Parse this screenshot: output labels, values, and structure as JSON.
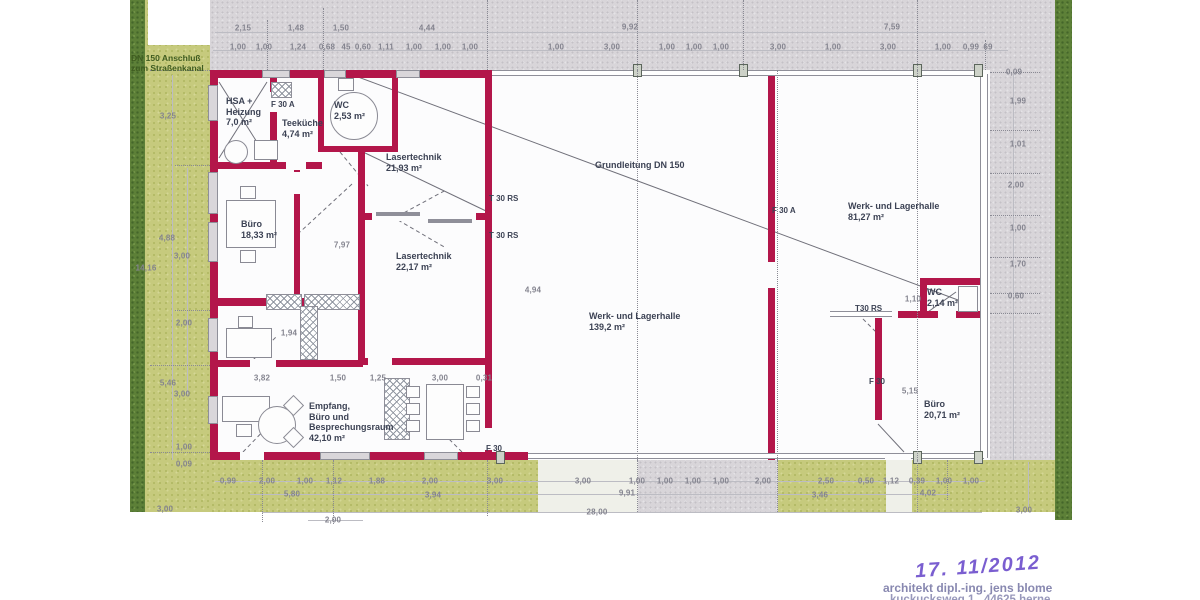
{
  "title": "Grundriss Werk- und Lagerhalle",
  "colors": {
    "wall": "#b3164a",
    "gray_wall": "#8f8f99",
    "pavement": "#d8d5d9",
    "green": "#c6ca7d",
    "green_dark": "#5d8038",
    "dim_text": "#84848f",
    "room_text": "#3c4254",
    "stamp_purple": "#7a5ed0",
    "stamp_gray": "#8888b0"
  },
  "stamp": {
    "date": "17. 11/2012",
    "line1": "architekt dipl.-ing. jens blome",
    "line2": "kuckucksweg 1 . 44625 herne"
  },
  "labels": [
    {
      "t": "DN 150 Anschluß\nzum Straßenkanal",
      "x": 131,
      "y": 53,
      "c": "site"
    },
    {
      "t": "HSA +\nHeizung\n7,0 m²",
      "x": 226,
      "y": 96,
      "c": "room"
    },
    {
      "t": "F 30 A",
      "x": 271,
      "y": 100,
      "c": "door"
    },
    {
      "t": "Teeküche\n4,74 m²",
      "x": 282,
      "y": 118,
      "c": "room"
    },
    {
      "t": "WC\n2,53 m²",
      "x": 334,
      "y": 100,
      "c": "room"
    },
    {
      "t": "Lasertechnik\n21,93 m²",
      "x": 386,
      "y": 152,
      "c": "room"
    },
    {
      "t": "T 30 RS",
      "x": 489,
      "y": 194,
      "c": "door"
    },
    {
      "t": "T 30 RS",
      "x": 489,
      "y": 231,
      "c": "door"
    },
    {
      "t": "Lasertechnik\n22,17 m²",
      "x": 396,
      "y": 251,
      "c": "room"
    },
    {
      "t": "Büro\n18,33 m²",
      "x": 241,
      "y": 219,
      "c": "room"
    },
    {
      "t": "Grundleitung DN 150",
      "x": 595,
      "y": 160,
      "c": "room"
    },
    {
      "t": "F 30 A",
      "x": 772,
      "y": 206,
      "c": "door"
    },
    {
      "t": "Werk- und Lagerhalle\n81,27 m²",
      "x": 848,
      "y": 201,
      "c": "room"
    },
    {
      "t": "Werk- und Lagerhalle\n139,2 m²",
      "x": 589,
      "y": 311,
      "c": "room"
    },
    {
      "t": "WC\n2,14 m²",
      "x": 927,
      "y": 287,
      "c": "room"
    },
    {
      "t": "T30 RS",
      "x": 855,
      "y": 304,
      "c": "door"
    },
    {
      "t": "F 30",
      "x": 869,
      "y": 377,
      "c": "door"
    },
    {
      "t": "Büro\n20,71 m²",
      "x": 924,
      "y": 399,
      "c": "room"
    },
    {
      "t": "Empfang,\nBüro und\nBesprechungsraum\n42,10 m²",
      "x": 309,
      "y": 401,
      "c": "room"
    },
    {
      "t": "F 30",
      "x": 486,
      "y": 444,
      "c": "door"
    }
  ],
  "dims": [
    [
      "2,15",
      243,
      28
    ],
    [
      "1,48",
      296,
      28
    ],
    [
      "1,50",
      341,
      28
    ],
    [
      "4,44",
      427,
      28
    ],
    [
      "9,92",
      630,
      27
    ],
    [
      "7,59",
      892,
      27
    ],
    [
      "1,00",
      238,
      47
    ],
    [
      "1,00",
      264,
      47
    ],
    [
      "1,24",
      298,
      47
    ],
    [
      "0,68",
      327,
      47
    ],
    [
      "45",
      346,
      47
    ],
    [
      "0,60",
      363,
      47
    ],
    [
      "1,11",
      386,
      47
    ],
    [
      "1,00",
      414,
      47
    ],
    [
      "1,00",
      443,
      47
    ],
    [
      "1,00",
      470,
      47
    ],
    [
      "1,00",
      556,
      47
    ],
    [
      "3,00",
      612,
      47
    ],
    [
      "1,00",
      667,
      47
    ],
    [
      "1,00",
      694,
      47
    ],
    [
      "1,00",
      721,
      47
    ],
    [
      "3,00",
      778,
      47
    ],
    [
      "1,00",
      833,
      47
    ],
    [
      "3,00",
      888,
      47
    ],
    [
      "1,00",
      943,
      47
    ],
    [
      "0,99",
      971,
      47
    ],
    [
      "69",
      988,
      47
    ],
    [
      "0,09",
      1014,
      72
    ],
    [
      "3,25",
      168,
      116
    ],
    [
      "4,88",
      167,
      238
    ],
    [
      "3,00",
      182,
      256
    ],
    [
      "14,16",
      146,
      268
    ],
    [
      "2,00",
      184,
      323
    ],
    [
      "5,46",
      168,
      383
    ],
    [
      "3,00",
      182,
      394
    ],
    [
      "1,00",
      184,
      447
    ],
    [
      "0,09",
      184,
      464
    ],
    [
      "3,00",
      165,
      509
    ],
    [
      "1,99",
      1018,
      101
    ],
    [
      "1,01",
      1018,
      144
    ],
    [
      "2,00",
      1016,
      185
    ],
    [
      "1,00",
      1018,
      228
    ],
    [
      "1,70",
      1018,
      264
    ],
    [
      "0,60",
      1016,
      296
    ],
    [
      "3,00",
      1024,
      510
    ],
    [
      "7,97",
      342,
      245
    ],
    [
      "1,94",
      289,
      333
    ],
    [
      "4,94",
      533,
      290
    ],
    [
      "1,10",
      913,
      299
    ],
    [
      "5,15",
      910,
      391
    ],
    [
      "3,82",
      262,
      378
    ],
    [
      "1,50",
      338,
      378
    ],
    [
      "1,25",
      378,
      378
    ],
    [
      "3,00",
      440,
      378
    ],
    [
      "0,31",
      484,
      378
    ],
    [
      "0,99",
      228,
      481
    ],
    [
      "2,00",
      267,
      481
    ],
    [
      "1,00",
      305,
      481
    ],
    [
      "1,12",
      334,
      481
    ],
    [
      "1,88",
      377,
      481
    ],
    [
      "2,00",
      430,
      481
    ],
    [
      "3,00",
      495,
      481
    ],
    [
      "3,00",
      583,
      481
    ],
    [
      "1,00",
      637,
      481
    ],
    [
      "1,00",
      665,
      481
    ],
    [
      "1,00",
      693,
      481
    ],
    [
      "1,00",
      721,
      481
    ],
    [
      "2,00",
      763,
      481
    ],
    [
      "2,50",
      826,
      481
    ],
    [
      "0,50",
      866,
      481
    ],
    [
      "1,12",
      891,
      481
    ],
    [
      "0,39",
      917,
      481
    ],
    [
      "1,00",
      944,
      481
    ],
    [
      "1,00",
      971,
      481
    ],
    [
      "5,80",
      292,
      494
    ],
    [
      "3,94",
      433,
      495
    ],
    [
      "9,91",
      627,
      493
    ],
    [
      "3,46",
      820,
      495
    ],
    [
      "4,02",
      928,
      493
    ],
    [
      "2,00",
      333,
      520
    ],
    [
      "28,00",
      597,
      512
    ]
  ],
  "geometry": {
    "walls": [
      [
        210,
        70,
        54,
        8
      ],
      [
        290,
        70,
        34,
        8
      ],
      [
        346,
        70,
        50,
        8
      ],
      [
        420,
        70,
        72,
        8
      ],
      [
        210,
        70,
        8,
        390
      ],
      [
        210,
        452,
        32,
        8
      ],
      [
        264,
        452,
        58,
        8
      ],
      [
        370,
        452,
        54,
        8
      ],
      [
        458,
        452,
        70,
        8
      ],
      [
        485,
        70,
        7,
        382
      ],
      [
        768,
        70,
        7,
        390
      ],
      [
        358,
        150,
        7,
        215
      ],
      [
        318,
        70,
        6,
        82
      ],
      [
        270,
        70,
        7,
        96
      ],
      [
        392,
        70,
        6,
        80
      ],
      [
        294,
        166,
        6,
        142
      ],
      [
        212,
        162,
        110,
        7
      ],
      [
        318,
        146,
        80,
        6
      ],
      [
        363,
        213,
        127,
        7
      ],
      [
        212,
        298,
        151,
        8
      ],
      [
        212,
        360,
        151,
        7
      ],
      [
        363,
        358,
        127,
        7
      ],
      [
        923,
        278,
        62,
        7
      ],
      [
        920,
        278,
        7,
        40
      ],
      [
        898,
        311,
        87,
        7
      ],
      [
        875,
        318,
        7,
        102
      ]
    ],
    "gwalls": [
      [
        492,
        70,
        490,
        6
      ],
      [
        528,
        453,
        456,
        6
      ],
      [
        980,
        74,
        8,
        384
      ],
      [
        830,
        311,
        62,
        6
      ]
    ],
    "gbars": [
      [
        376,
        212,
        44,
        4
      ],
      [
        428,
        219,
        44,
        4
      ]
    ],
    "gaps": [
      [
        269,
        92,
        9,
        20
      ],
      [
        293,
        172,
        8,
        22
      ],
      [
        286,
        160,
        20,
        10
      ],
      [
        250,
        359,
        26,
        9
      ],
      [
        368,
        357,
        24,
        9
      ],
      [
        372,
        212,
        104,
        9
      ],
      [
        484,
        428,
        9,
        22
      ],
      [
        767,
        262,
        9,
        26
      ],
      [
        240,
        452,
        24,
        8
      ],
      [
        938,
        311,
        18,
        7
      ],
      [
        885,
        454,
        26,
        5
      ]
    ],
    "windows": [
      [
        262,
        70,
        28,
        8
      ],
      [
        324,
        70,
        22,
        8
      ],
      [
        396,
        70,
        24,
        8
      ],
      [
        208,
        85,
        10,
        36
      ],
      [
        208,
        172,
        10,
        42
      ],
      [
        208,
        222,
        10,
        40
      ],
      [
        208,
        318,
        10,
        34
      ],
      [
        208,
        396,
        10,
        28
      ],
      [
        320,
        452,
        50,
        8
      ],
      [
        424,
        452,
        34,
        8
      ]
    ],
    "posts": [
      [
        633,
        64
      ],
      [
        739,
        64
      ],
      [
        913,
        64
      ],
      [
        974,
        64
      ],
      [
        496,
        451
      ],
      [
        913,
        451
      ],
      [
        974,
        451
      ]
    ],
    "hatches": [
      [
        266,
        294,
        36,
        16
      ],
      [
        304,
        294,
        56,
        16
      ],
      [
        271,
        82,
        21,
        16
      ],
      [
        384,
        378,
        26,
        62
      ],
      [
        300,
        306,
        18,
        54
      ]
    ],
    "furniture": {
      "rects": [
        [
          254,
          140,
          24,
          20
        ],
        [
          338,
          78,
          16,
          13
        ],
        [
          226,
          200,
          50,
          48
        ],
        [
          240,
          186,
          16,
          13
        ],
        [
          240,
          250,
          16,
          13
        ],
        [
          226,
          328,
          46,
          30
        ],
        [
          238,
          316,
          15,
          12
        ],
        [
          222,
          396,
          48,
          26
        ],
        [
          236,
          424,
          16,
          13
        ],
        [
          426,
          384,
          38,
          56
        ],
        [
          406,
          386,
          14,
          12
        ],
        [
          406,
          403,
          14,
          12
        ],
        [
          406,
          420,
          14,
          12
        ],
        [
          466,
          386,
          14,
          12
        ],
        [
          466,
          403,
          14,
          12
        ],
        [
          466,
          420,
          14,
          12
        ],
        [
          958,
          286,
          20,
          26
        ]
      ],
      "circles": [
        [
          224,
          140,
          24
        ],
        [
          330,
          92,
          48
        ],
        [
          258,
          406,
          38
        ]
      ],
      "diamonds": [
        [
          286,
          398,
          15
        ],
        [
          286,
          430,
          15
        ]
      ]
    },
    "lines": [
      [
        350,
        74,
        958,
        300,
        0
      ],
      [
        363,
        152,
        486,
        211,
        0
      ],
      [
        219,
        82,
        267,
        158,
        0
      ],
      [
        267,
        82,
        219,
        158,
        0
      ],
      [
        352,
        184,
        300,
        232,
        1
      ],
      [
        340,
        152,
        368,
        186,
        1
      ],
      [
        243,
        452,
        270,
        424,
        1
      ],
      [
        398,
        216,
        446,
        190,
        1
      ],
      [
        398,
        220,
        446,
        248,
        1
      ],
      [
        462,
        452,
        436,
        426,
        1
      ],
      [
        858,
        314,
        882,
        338,
        1
      ],
      [
        878,
        424,
        904,
        452,
        0
      ],
      [
        925,
        314,
        956,
        292,
        0
      ],
      [
        253,
        360,
        277,
        336,
        1
      ]
    ],
    "dotted_v": [
      [
        267,
        20,
        50
      ],
      [
        323,
        8,
        62
      ],
      [
        487,
        0,
        70
      ],
      [
        637,
        0,
        70
      ],
      [
        743,
        0,
        70
      ],
      [
        917,
        0,
        70
      ],
      [
        985,
        40,
        30
      ],
      [
        637,
        70,
        390
      ],
      [
        777,
        70,
        390
      ],
      [
        917,
        70,
        390
      ],
      [
        262,
        460,
        62
      ],
      [
        333,
        460,
        64
      ],
      [
        487,
        460,
        56
      ],
      [
        637,
        460,
        52
      ],
      [
        777,
        460,
        52
      ],
      [
        917,
        460,
        52
      ],
      [
        947,
        460,
        40
      ]
    ],
    "dotted_h": [
      [
        150,
        70,
        60
      ],
      [
        175,
        165,
        35
      ],
      [
        175,
        310,
        35
      ],
      [
        150,
        365,
        60
      ],
      [
        150,
        452,
        60
      ],
      [
        990,
        72,
        50
      ],
      [
        990,
        130,
        50
      ],
      [
        990,
        173,
        50
      ],
      [
        990,
        215,
        50
      ],
      [
        990,
        257,
        50
      ],
      [
        990,
        293,
        50
      ],
      [
        990,
        313,
        50
      ]
    ],
    "guides_h": [
      [
        215,
        32,
        770
      ],
      [
        213,
        50,
        795
      ],
      [
        215,
        481,
        770
      ],
      [
        250,
        494,
        700
      ],
      [
        262,
        512,
        720
      ],
      [
        308,
        520,
        55
      ]
    ],
    "guides_v": [
      [
        172,
        75,
        385
      ],
      [
        187,
        168,
        226
      ],
      [
        1013,
        74,
        386
      ],
      [
        1028,
        462,
        50
      ]
    ]
  }
}
